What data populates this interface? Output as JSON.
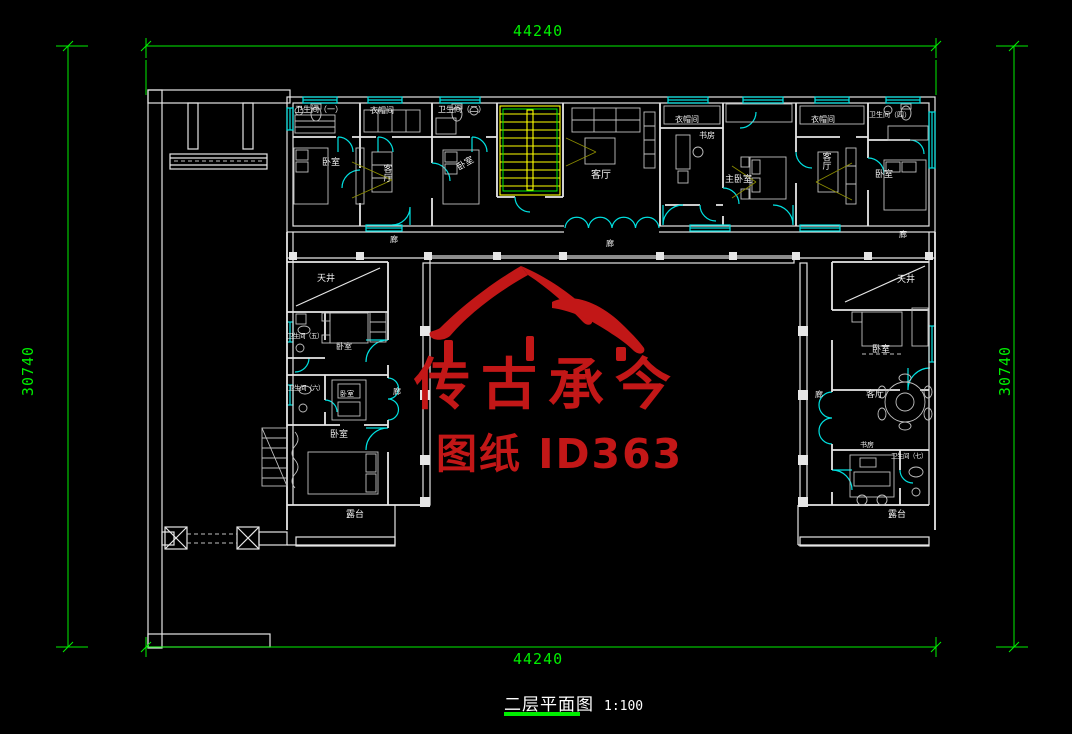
{
  "drawing": {
    "title": {
      "text": "二层平面图",
      "scale": "1:100"
    },
    "dimensions": {
      "top": "44240",
      "bottom": "44240",
      "left": "30740",
      "right": "30740"
    },
    "watermark": {
      "brand": "传古承今",
      "sheet_id": "图纸 ID363"
    }
  },
  "rooms": {
    "bath1": "卫生间（一）",
    "cloak1": "衣帽间",
    "bath2": "卫生间（二）",
    "bed_nw": "卧室",
    "living_nw": "客厅",
    "bed_n2": "卧室",
    "living_center": "客厅",
    "cloak2": "衣帽间",
    "study_n": "书房",
    "master_bed": "主卧室",
    "cloak3": "衣帽间",
    "bath4": "卫生间（四）",
    "living_ne": "客厅",
    "bed_ne": "卧室",
    "corridor": "廊",
    "skywell_w": "天井",
    "bath5": "卫生间（五）",
    "bed_w1": "卧室",
    "bath6": "卫生间（六）",
    "bed_w2": "卧室",
    "bed_w3": "卧室",
    "terrace_w": "露台",
    "skywell_e": "天井",
    "bed_e1": "卧室",
    "living_e": "客厅",
    "study_e": "书房",
    "bath7": "卫生间（七）",
    "terrace_e": "露台"
  },
  "colors": {
    "background": "#000000",
    "wall": "#e6e6e6",
    "opening": "#00e1e1",
    "dimension": "#00ee00",
    "stairs": "#ffff00",
    "furniture": "#c0c0c0",
    "accent": "#8a8a00",
    "watermark": "#c21717",
    "label": "#f2f2f2"
  }
}
